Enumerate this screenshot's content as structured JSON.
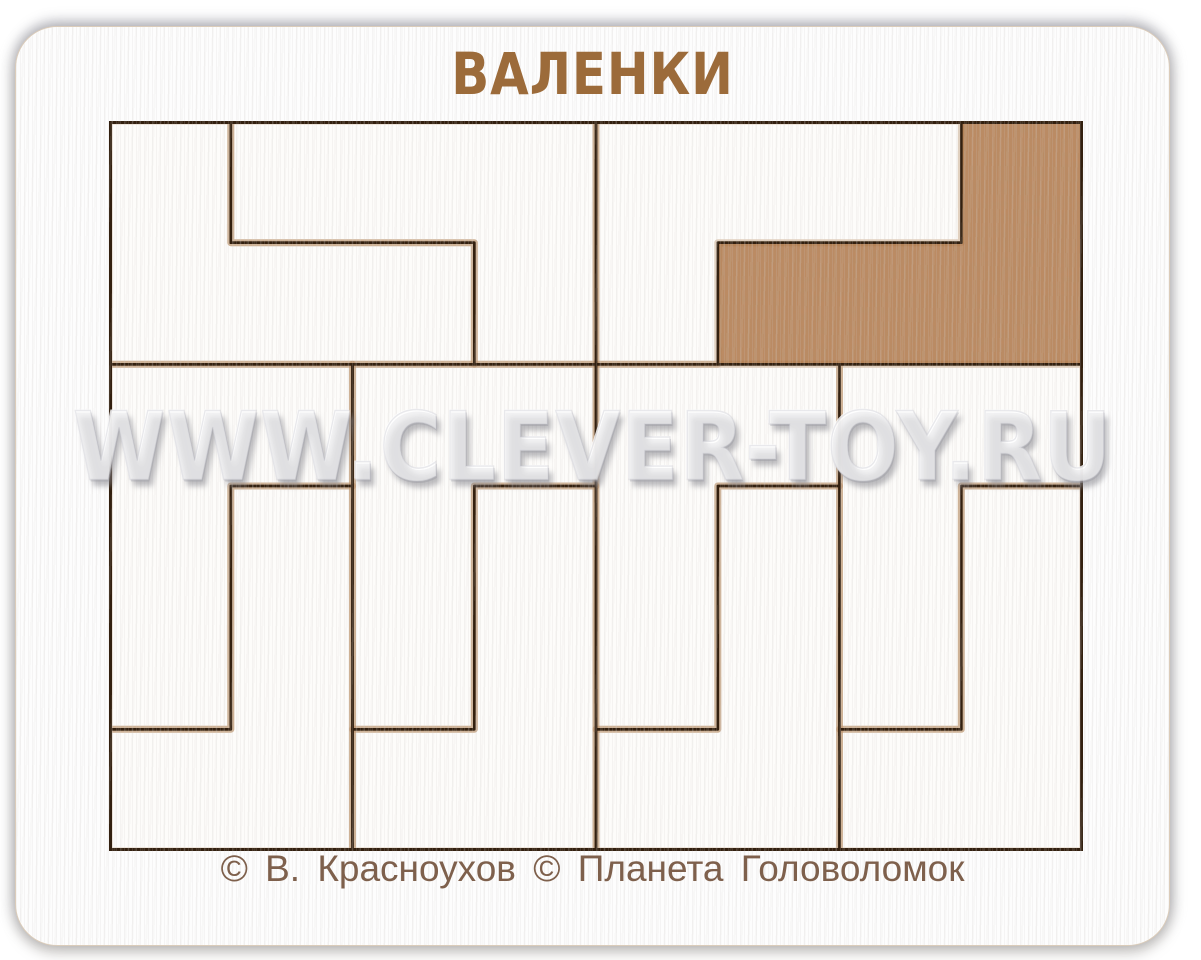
{
  "title": "ВАЛЕНКИ",
  "watermark": "WWW.CLEVER-TOY.RU",
  "copyright": "© В. Красноухов © Планета  Головоломок",
  "colors": {
    "title_text": "#9c6b3a",
    "copyright_text": "#7e604c",
    "engrave_line": "#33200f",
    "scorch": "rgba(168,116,64,0.32)",
    "mdf_brown": "#bd8b63",
    "mdf_speckle_dark": "#9e6f4b",
    "piece_white": "#fdfcfa",
    "watermark_fill": "rgba(255,255,255,0.62)",
    "watermark_shadow": "rgba(133,133,140,0.55)"
  },
  "puzzle": {
    "grid": {
      "cols": 8,
      "rows": 6
    },
    "empty_slot": {
      "name": "empty-slot",
      "polygon": [
        [
          7,
          0
        ],
        [
          8,
          0
        ],
        [
          8,
          2
        ],
        [
          5,
          2
        ],
        [
          5,
          1
        ],
        [
          7,
          1
        ]
      ]
    },
    "pieces": [
      {
        "name": "piece-top-left-lower-boot",
        "polygon": [
          [
            0,
            0
          ],
          [
            1,
            0
          ],
          [
            1,
            1
          ],
          [
            3,
            1
          ],
          [
            3,
            2
          ],
          [
            0,
            2
          ]
        ]
      },
      {
        "name": "piece-top-left-upper-boot",
        "polygon": [
          [
            1,
            0
          ],
          [
            4,
            0
          ],
          [
            4,
            2
          ],
          [
            3,
            2
          ],
          [
            3,
            1
          ],
          [
            1,
            1
          ]
        ]
      },
      {
        "name": "piece-top-right-boot",
        "polygon": [
          [
            4,
            0
          ],
          [
            7,
            0
          ],
          [
            7,
            1
          ],
          [
            5,
            1
          ],
          [
            5,
            2
          ],
          [
            4,
            2
          ]
        ]
      },
      {
        "name": "piece-strip1-upper-boot",
        "polygon": [
          [
            0,
            2
          ],
          [
            2,
            2
          ],
          [
            2,
            3
          ],
          [
            1,
            3
          ],
          [
            1,
            5
          ],
          [
            0,
            5
          ]
        ]
      },
      {
        "name": "piece-strip1-lower-boot",
        "polygon": [
          [
            1,
            3
          ],
          [
            2,
            3
          ],
          [
            2,
            6
          ],
          [
            0,
            6
          ],
          [
            0,
            5
          ],
          [
            1,
            5
          ]
        ]
      },
      {
        "name": "piece-strip2-upper-boot",
        "polygon": [
          [
            2,
            2
          ],
          [
            4,
            2
          ],
          [
            4,
            3
          ],
          [
            3,
            3
          ],
          [
            3,
            5
          ],
          [
            2,
            5
          ]
        ]
      },
      {
        "name": "piece-strip2-lower-boot",
        "polygon": [
          [
            3,
            3
          ],
          [
            4,
            3
          ],
          [
            4,
            6
          ],
          [
            2,
            6
          ],
          [
            2,
            5
          ],
          [
            3,
            5
          ]
        ]
      },
      {
        "name": "piece-strip3-upper-boot",
        "polygon": [
          [
            4,
            2
          ],
          [
            6,
            2
          ],
          [
            6,
            3
          ],
          [
            5,
            3
          ],
          [
            5,
            5
          ],
          [
            4,
            5
          ]
        ]
      },
      {
        "name": "piece-strip3-lower-boot",
        "polygon": [
          [
            5,
            3
          ],
          [
            6,
            3
          ],
          [
            6,
            6
          ],
          [
            4,
            6
          ],
          [
            4,
            5
          ],
          [
            5,
            5
          ]
        ]
      },
      {
        "name": "piece-strip4-upper-boot",
        "polygon": [
          [
            6,
            2
          ],
          [
            8,
            2
          ],
          [
            8,
            3
          ],
          [
            7,
            3
          ],
          [
            7,
            5
          ],
          [
            6,
            5
          ]
        ]
      },
      {
        "name": "piece-strip4-lower-boot",
        "polygon": [
          [
            7,
            3
          ],
          [
            8,
            3
          ],
          [
            8,
            6
          ],
          [
            6,
            6
          ],
          [
            6,
            5
          ],
          [
            7,
            5
          ]
        ]
      }
    ]
  }
}
